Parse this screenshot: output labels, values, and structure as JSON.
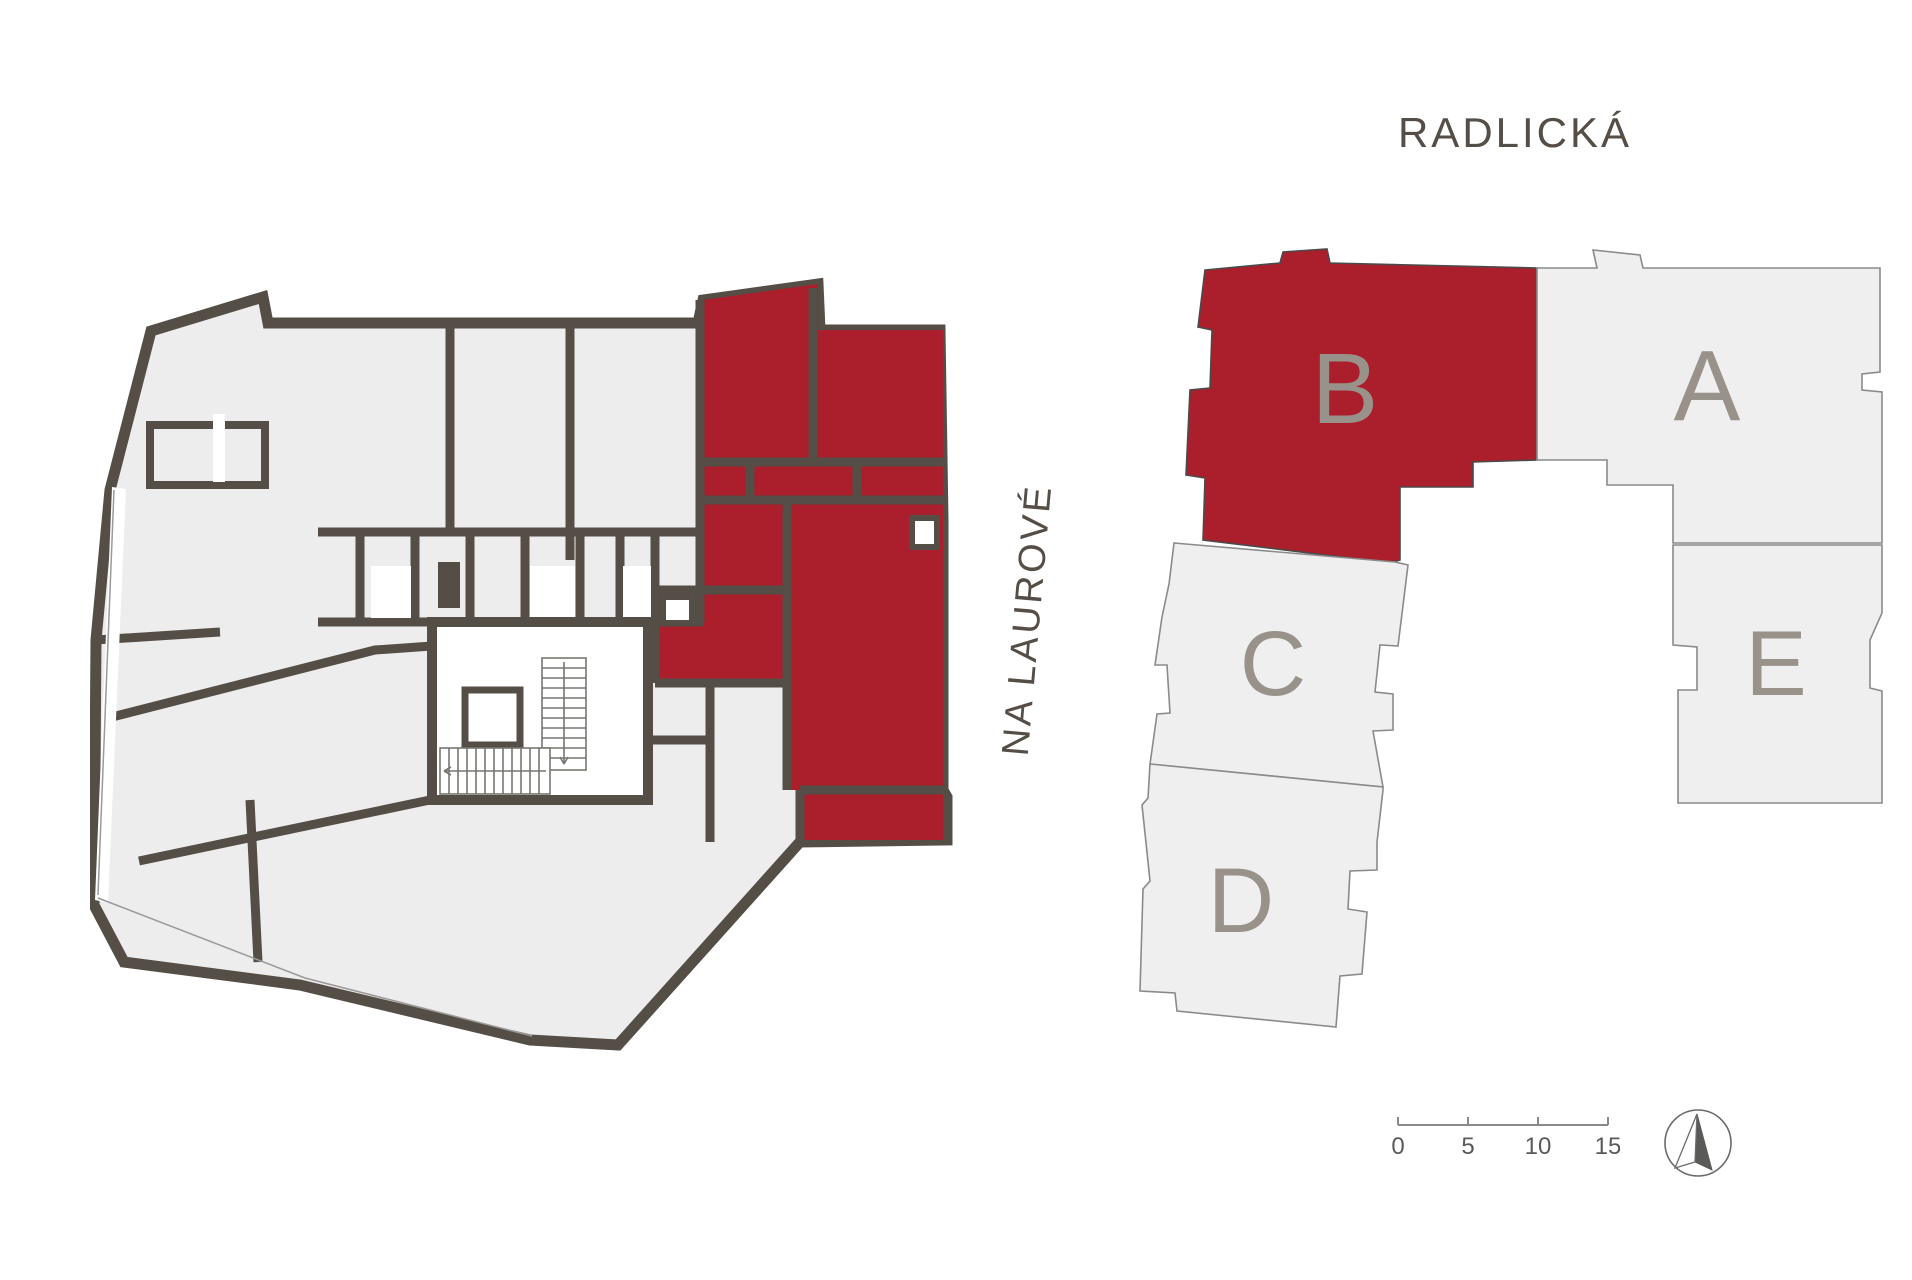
{
  "labels": {
    "street_top": "RADLICKÁ",
    "street_left": "NA LAUROVÉ"
  },
  "site_plan": {
    "blocks": [
      {
        "id": "b",
        "label": "B",
        "highlighted": true
      },
      {
        "id": "a",
        "label": "A",
        "highlighted": false
      },
      {
        "id": "c",
        "label": "C",
        "highlighted": false
      },
      {
        "id": "d",
        "label": "D",
        "highlighted": false
      },
      {
        "id": "e",
        "label": "E",
        "highlighted": false
      }
    ]
  },
  "floor_plan": {
    "highlighted_unit": "B"
  },
  "scale_bar": {
    "ticks": [
      "0",
      "5",
      "10",
      "15"
    ]
  },
  "colors": {
    "highlight_red": "#aa1f2b",
    "wall_dark": "#554e46",
    "room_gray": "#ededee",
    "block_fill": "#efefef",
    "block_outline": "#8a8a8a",
    "letter_gray": "#98928a",
    "text_dark": "#554e46",
    "scale_gray": "#5a5a5a"
  }
}
